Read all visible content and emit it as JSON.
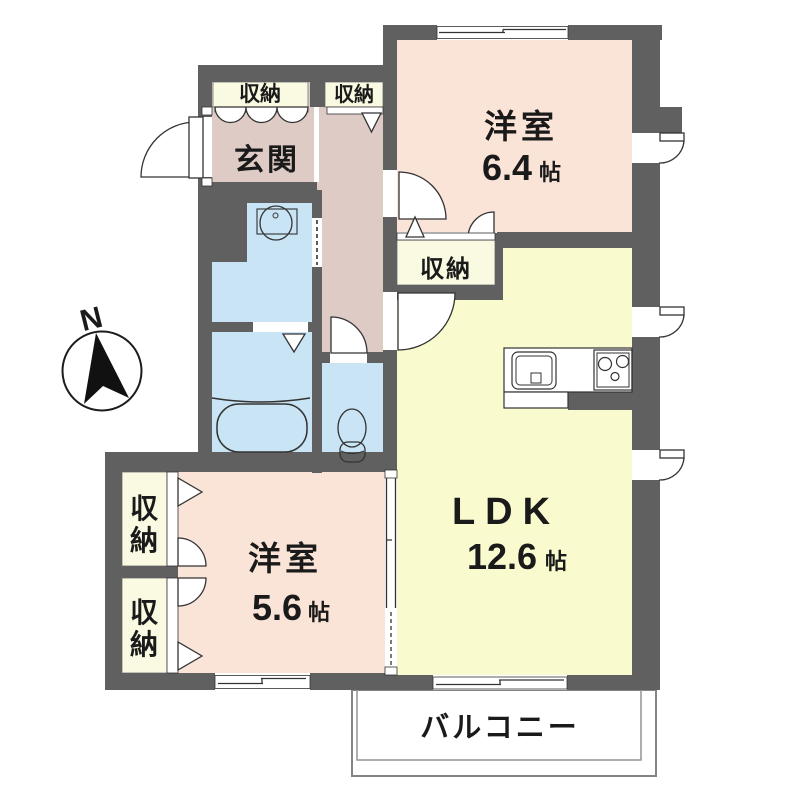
{
  "type": "floor_plan",
  "compass": {
    "label": "N"
  },
  "rooms": {
    "genkan": {
      "label": "玄関"
    },
    "bedroom_top": {
      "label": "洋室",
      "size_value": "6.4",
      "size_unit": "帖"
    },
    "bedroom_left": {
      "label": "洋室",
      "size_value": "5.6",
      "size_unit": "帖"
    },
    "ldk": {
      "label": "LDK",
      "size_value": "12.6",
      "size_unit": "帖"
    },
    "balcony": {
      "label": "バルコニー"
    }
  },
  "closets": {
    "label": "収納",
    "vertical": {
      "char1": "収",
      "char2": "納"
    }
  },
  "fixtures": [
    "bathtub",
    "washbasin",
    "toilet",
    "kitchen-sink",
    "kitchen-stove"
  ],
  "colors": {
    "wall": "#606060",
    "bedroom": "#FAE3D7",
    "ldk": "#FAFACF",
    "hall": "#DECBC6",
    "wet_area": "#C9E4F5",
    "closet": "#FAF9E1",
    "text": "#1A1A1A"
  }
}
